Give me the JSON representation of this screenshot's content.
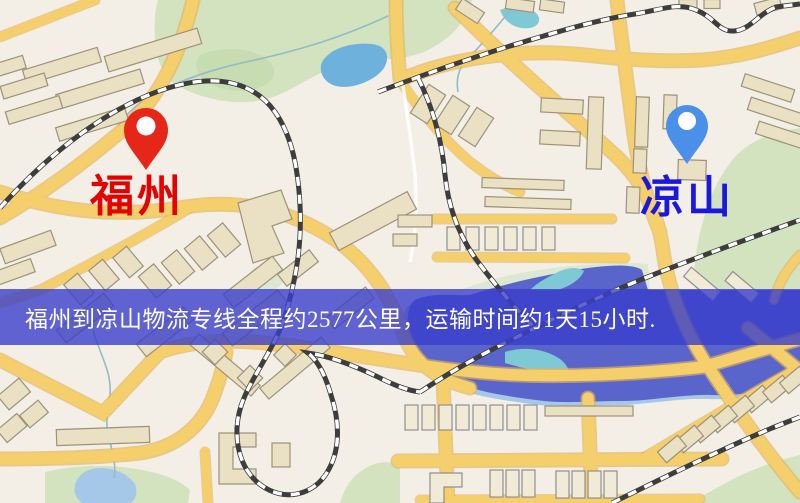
{
  "banner": {
    "text": "福州到凉山物流专线全程约2577公里，运输时间约1天15小时."
  },
  "markers": {
    "origin": {
      "label": "福州",
      "icon": "map-pin-icon"
    },
    "destination": {
      "label": "凉山",
      "icon": "map-pin-icon"
    }
  },
  "theme": {
    "map-bg": "#f4efe6",
    "road": "#f5cf6b",
    "road-casing": "#e3b257",
    "park": "#d3e3c0",
    "lake": "#6fb1dd",
    "water-dark": "#5a65cb",
    "building": "#eae0c4",
    "origin-pin": "#e62619",
    "origin-label": "#e60000",
    "dest-pin": "#4a90e8",
    "dest-label": "#1a18dd",
    "banner-bg": "rgba(57,63,203,0.8)",
    "banner-text": "#ffffff"
  }
}
